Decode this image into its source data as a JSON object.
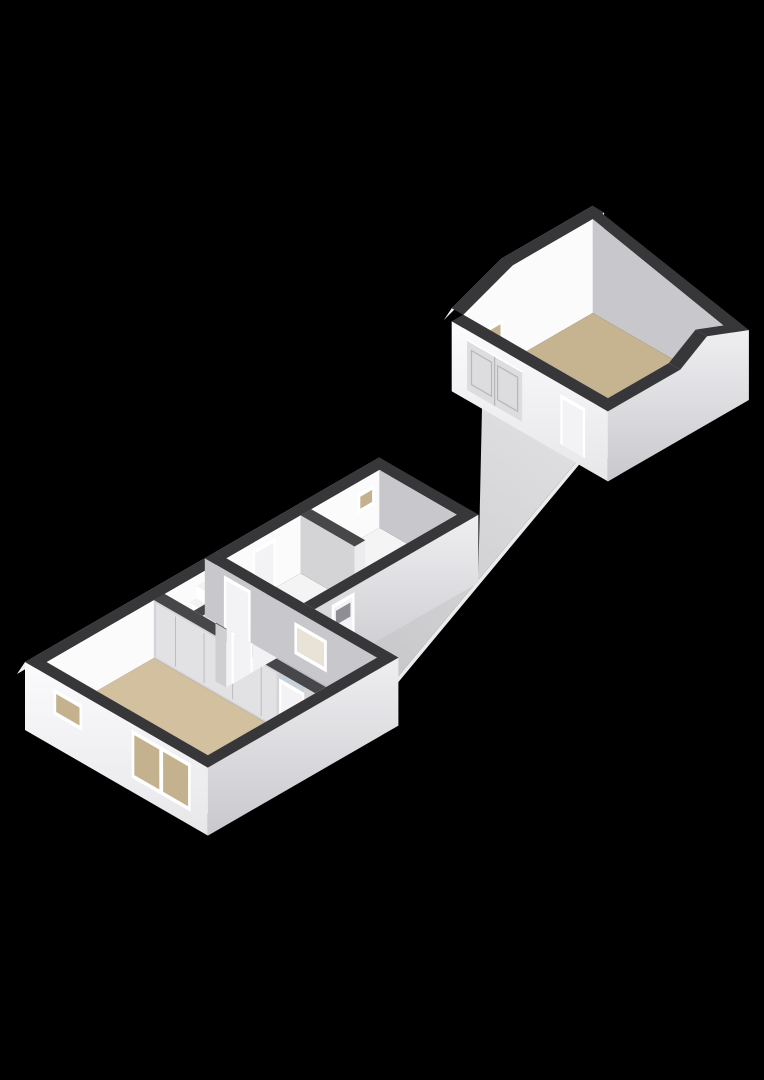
{
  "meta": {
    "type": "3d-floorplan-render",
    "view": "axonometric",
    "background": "#000000",
    "description": "Roofless 3D floor plan: house with living room, hall with stairs, bathroom; utility wing; outdoor walkway; detached gabled garage"
  },
  "colors": {
    "background": "#000000",
    "wallTop": "#37373a",
    "wallTopInner": "#47474a",
    "sliver": "#ededef",
    "innerBright": "#fbfbfc",
    "innerGray": "#c8c8cc",
    "innerMid": "#d4d4d7",
    "innerNearA": "#f2f2f4",
    "innerNearB": "#e8e8eb",
    "capLight": "#ececee",
    "capGray": "#cfcfd2",
    "closetDoor": "#e2e2e5",
    "seam": "#bdbdc1",
    "floorLiving": "#d2c09e",
    "floorGarage": "#c6b38f",
    "floorBath": "#c8d1d9",
    "floorWhite": "#f4f4f5",
    "walkwayNear": "#c5c5c8",
    "walkwayFar": "#dedee0",
    "walkwayEdge": "#ebebed",
    "frame": "#ffffff",
    "glassTan": "#c4b28e",
    "glassLight": "#e9e3d7",
    "door": "#f3f3f5",
    "doorPane": "#8e8e94",
    "doorLine": "#b8b8bc",
    "garageDoor": "#dddddf",
    "counter": "#fafafa",
    "counterSide": "#e2e2e5",
    "fixture": "#f2f2f4",
    "fixtureRing": "#b9b9bd",
    "stepTop": "#f2f2f3",
    "stepRise": "#ffffff",
    "stepSide": "#d8d8db",
    "outerLitTop": "#fbfbfd",
    "outerLitBottom": "#e7e7ea",
    "outerShadeTop": "#efeff2",
    "outerShadeBottom": "#c9c9cd"
  },
  "rooms": [
    {
      "id": "living-room",
      "floor": "floorLiving",
      "rect": [
        0.28,
        0.28,
        3.1,
        4.52
      ]
    },
    {
      "id": "hall",
      "floor": "floorWhite",
      "rect": [
        3.38,
        0.28,
        4.72,
        1.62
      ]
    },
    {
      "id": "bathroom",
      "floor": "floorBath",
      "rect": [
        3.38,
        1.9,
        4.72,
        4.52
      ]
    },
    {
      "id": "wing-room-1",
      "floor": "floorWhite",
      "rect": [
        5.28,
        0.28,
        6.95,
        2.32
      ]
    },
    {
      "id": "wing-room-2",
      "floor": "floorWhite",
      "rect": [
        7.23,
        0.28,
        9.02,
        2.32
      ]
    },
    {
      "id": "garage",
      "floor": "floorGarage",
      "rect": [
        13.6,
        -1.8,
        16.7,
        1.7
      ]
    }
  ],
  "walkway": {
    "id": "walkway",
    "polygon": [
      [
        5.05,
        2.6
      ],
      [
        9.3,
        2.6
      ],
      [
        13.3,
        -1.3
      ],
      [
        13.3,
        1.3
      ],
      [
        5.05,
        4.2
      ]
    ]
  },
  "features": [
    {
      "name": "living-room-large-window",
      "type": "window",
      "plane": "A",
      "pos": 0,
      "lo": 2.8,
      "hi": 4.35,
      "z1": 4,
      "z2": 52,
      "glass": "glassTan",
      "panes": 2
    },
    {
      "name": "living-room-small-window",
      "type": "window",
      "plane": "A",
      "pos": 0,
      "lo": 0.75,
      "hi": 1.5,
      "z1": 22,
      "z2": 48,
      "glass": "glassTan",
      "panes": 1
    },
    {
      "name": "bathroom-window",
      "type": "window",
      "plane": "A",
      "pos": 4.72,
      "lo": 2.35,
      "hi": 3.2,
      "z1": 14,
      "z2": 46,
      "glass": "glassLight",
      "panes": 1
    },
    {
      "name": "wing-room2-window",
      "type": "window",
      "plane": "B",
      "pos": 0.28,
      "lo": 8.45,
      "hi": 8.9,
      "z1": 26,
      "z2": 46,
      "glass": "glassTan",
      "panes": 1
    },
    {
      "name": "garage-gable-window",
      "type": "window",
      "plane": "B",
      "pos": -1.8,
      "lo": 13.75,
      "hi": 14.35,
      "z1": 26,
      "z2": 46,
      "glass": "glassTan",
      "panes": 1
    },
    {
      "name": "hall-passage-door",
      "type": "door",
      "plane": "A",
      "pos": 4.72,
      "lo": 0.5,
      "hi": 1.2,
      "z1": 0,
      "z2": 52
    },
    {
      "name": "living-room-door",
      "type": "door",
      "plane": "A",
      "pos": 3.1,
      "lo": 3.57,
      "hi": 4.23,
      "z1": 0,
      "z2": 52
    },
    {
      "name": "bathroom-door",
      "type": "door",
      "plane": "B",
      "pos": 1.9,
      "lo": 3.52,
      "hi": 4.08,
      "z1": 0,
      "z2": 52
    },
    {
      "name": "wing-room1-door",
      "type": "door",
      "plane": "B",
      "pos": 0.28,
      "lo": 5.7,
      "hi": 6.3,
      "z1": 0,
      "z2": 50
    },
    {
      "name": "entrance-door",
      "type": "door",
      "plane": "B",
      "pos": 2.6,
      "lo": 5.45,
      "hi": 6.05,
      "z1": 0,
      "z2": 52,
      "pane": [
        5.56,
        5.94,
        30,
        44
      ]
    },
    {
      "name": "garage-double-door",
      "type": "garage-door",
      "plane": "A",
      "pos": 13.3,
      "lo": -1.7,
      "hi": -0.25,
      "z1": 0,
      "z2": 50
    },
    {
      "name": "garage-side-door",
      "type": "door",
      "plane": "A",
      "pos": 13.3,
      "lo": 0.75,
      "hi": 1.4,
      "z1": 0,
      "z2": 50
    },
    {
      "name": "staircase",
      "type": "stairs",
      "a": 3.6,
      "b1": 0.3,
      "b2": 1.02,
      "steps": 4,
      "tread": 0.2,
      "rise": 12
    },
    {
      "name": "kitchen-counter",
      "type": "counter",
      "rect": [
        5.9,
        1.75,
        6.9,
        2.32
      ],
      "h": 14
    },
    {
      "name": "toilet-fixture",
      "type": "disc",
      "at": [
        8.9,
        1.95
      ],
      "rx": 7,
      "ry": 4
    }
  ]
}
